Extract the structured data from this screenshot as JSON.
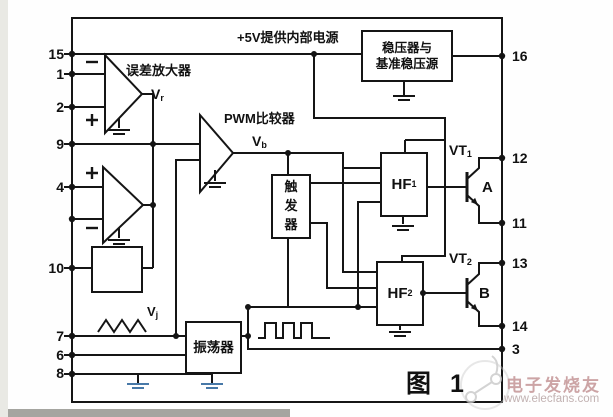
{
  "diagram": {
    "title_note": "+5V提供内部电源",
    "error_amp_label": "误差放大器",
    "pwm_comparator_label": "PWM比较器",
    "regulator_label": "稳压器与\n基准稳压源",
    "trigger_label": "触\n发\n器",
    "oscillator_label": "振荡器",
    "figure_caption": "图 1",
    "signals": {
      "vr": {
        "base": "V",
        "sub": "r"
      },
      "vb": {
        "base": "V",
        "sub": "b"
      },
      "vj": {
        "base": "V",
        "sub": "j"
      }
    },
    "blocks": {
      "hf1": {
        "base": "HF",
        "sub": "1"
      },
      "hf2": {
        "base": "HF",
        "sub": "2"
      }
    },
    "transistors": {
      "vt1": {
        "base": "VT",
        "sub": "1"
      },
      "vt1_region": "A",
      "vt2": {
        "base": "VT",
        "sub": "2"
      },
      "vt2_region": "B"
    },
    "pins": {
      "left": [
        "15",
        "1",
        "2",
        "9",
        "4",
        "10",
        "7",
        "6",
        "8"
      ],
      "right": [
        "16",
        "12",
        "11",
        "13",
        "14",
        "3"
      ]
    },
    "watermark": {
      "line1": "电子发烧友",
      "line2": "www.elecfans.com"
    }
  },
  "colors": {
    "line": "#151515",
    "blue_ground": "#4879a8",
    "watermark_text": "#c08e90"
  }
}
